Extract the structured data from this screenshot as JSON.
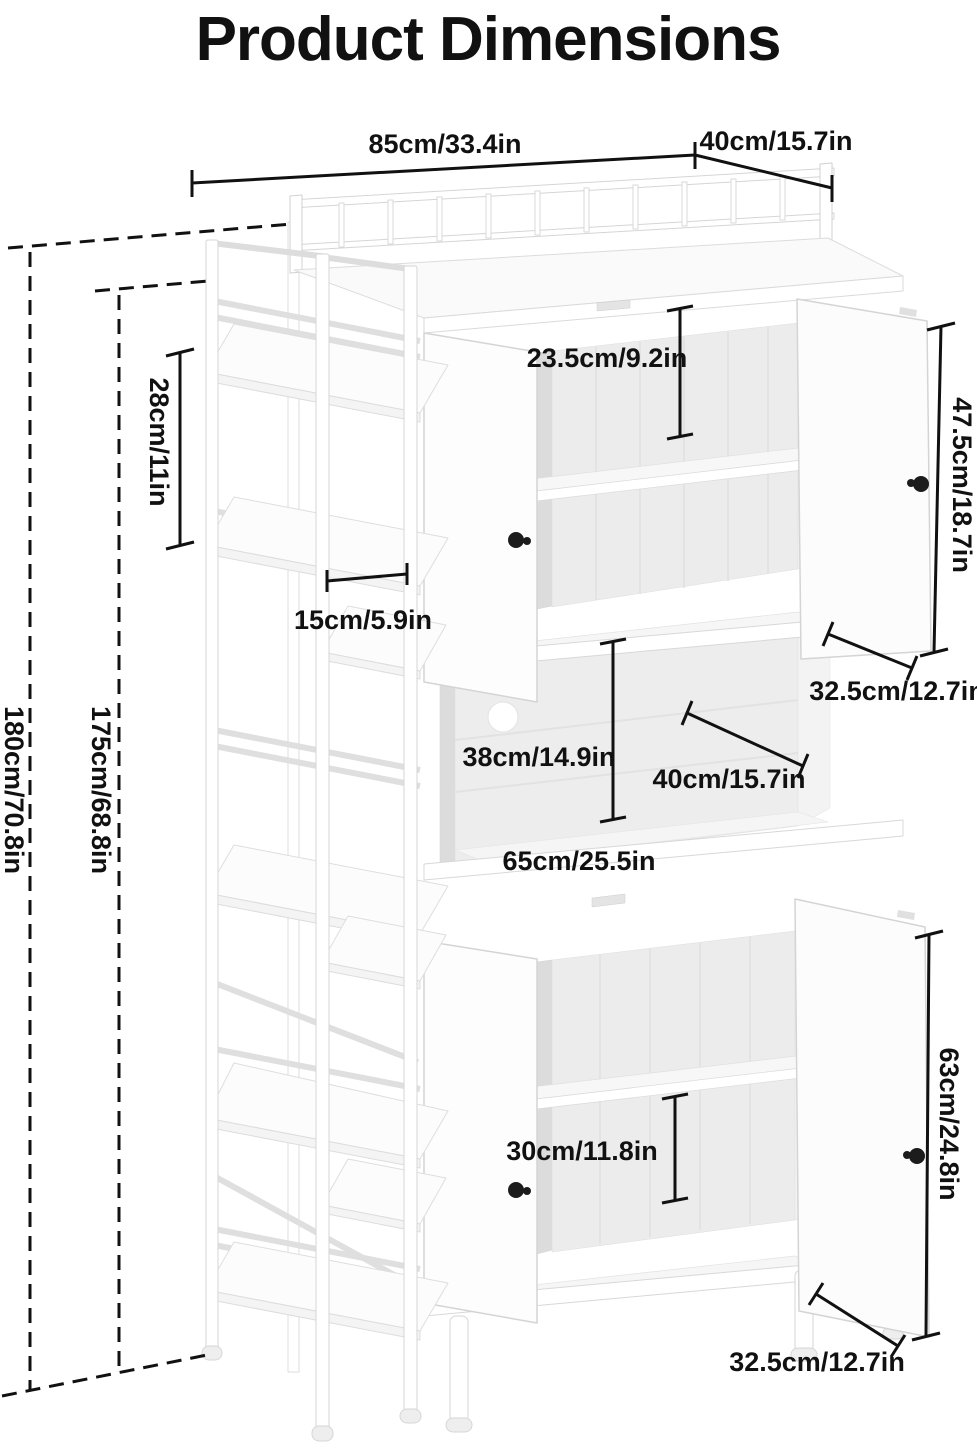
{
  "title": {
    "text": "Product Dimensions",
    "color": "#D09A55"
  },
  "colors": {
    "line": "#111111",
    "furniture_outline": "#d6d6d6",
    "interior": "#ececec"
  },
  "annotations": {
    "top_width": "85cm/33.4in",
    "top_depth": "40cm/15.7in",
    "total_height": "180cm/70.8in",
    "frame_height": "175cm/68.8in",
    "side_shelf_gap": "28cm/11in",
    "side_shelf_depth": "15cm/5.9in",
    "upper_compartment_height": "23.5cm/9.2in",
    "upper_door_height": "47.5cm/18.7in",
    "upper_door_width": "32.5cm/12.7in",
    "middle_compartment_height": "38cm/14.9in",
    "middle_compartment_depth": "40cm/15.7in",
    "middle_compartment_width": "65cm/25.5in",
    "lower_compartment_height": "30cm/11.8in",
    "lower_door_height": "63cm/24.8in",
    "lower_door_width": "32.5cm/12.7in"
  }
}
